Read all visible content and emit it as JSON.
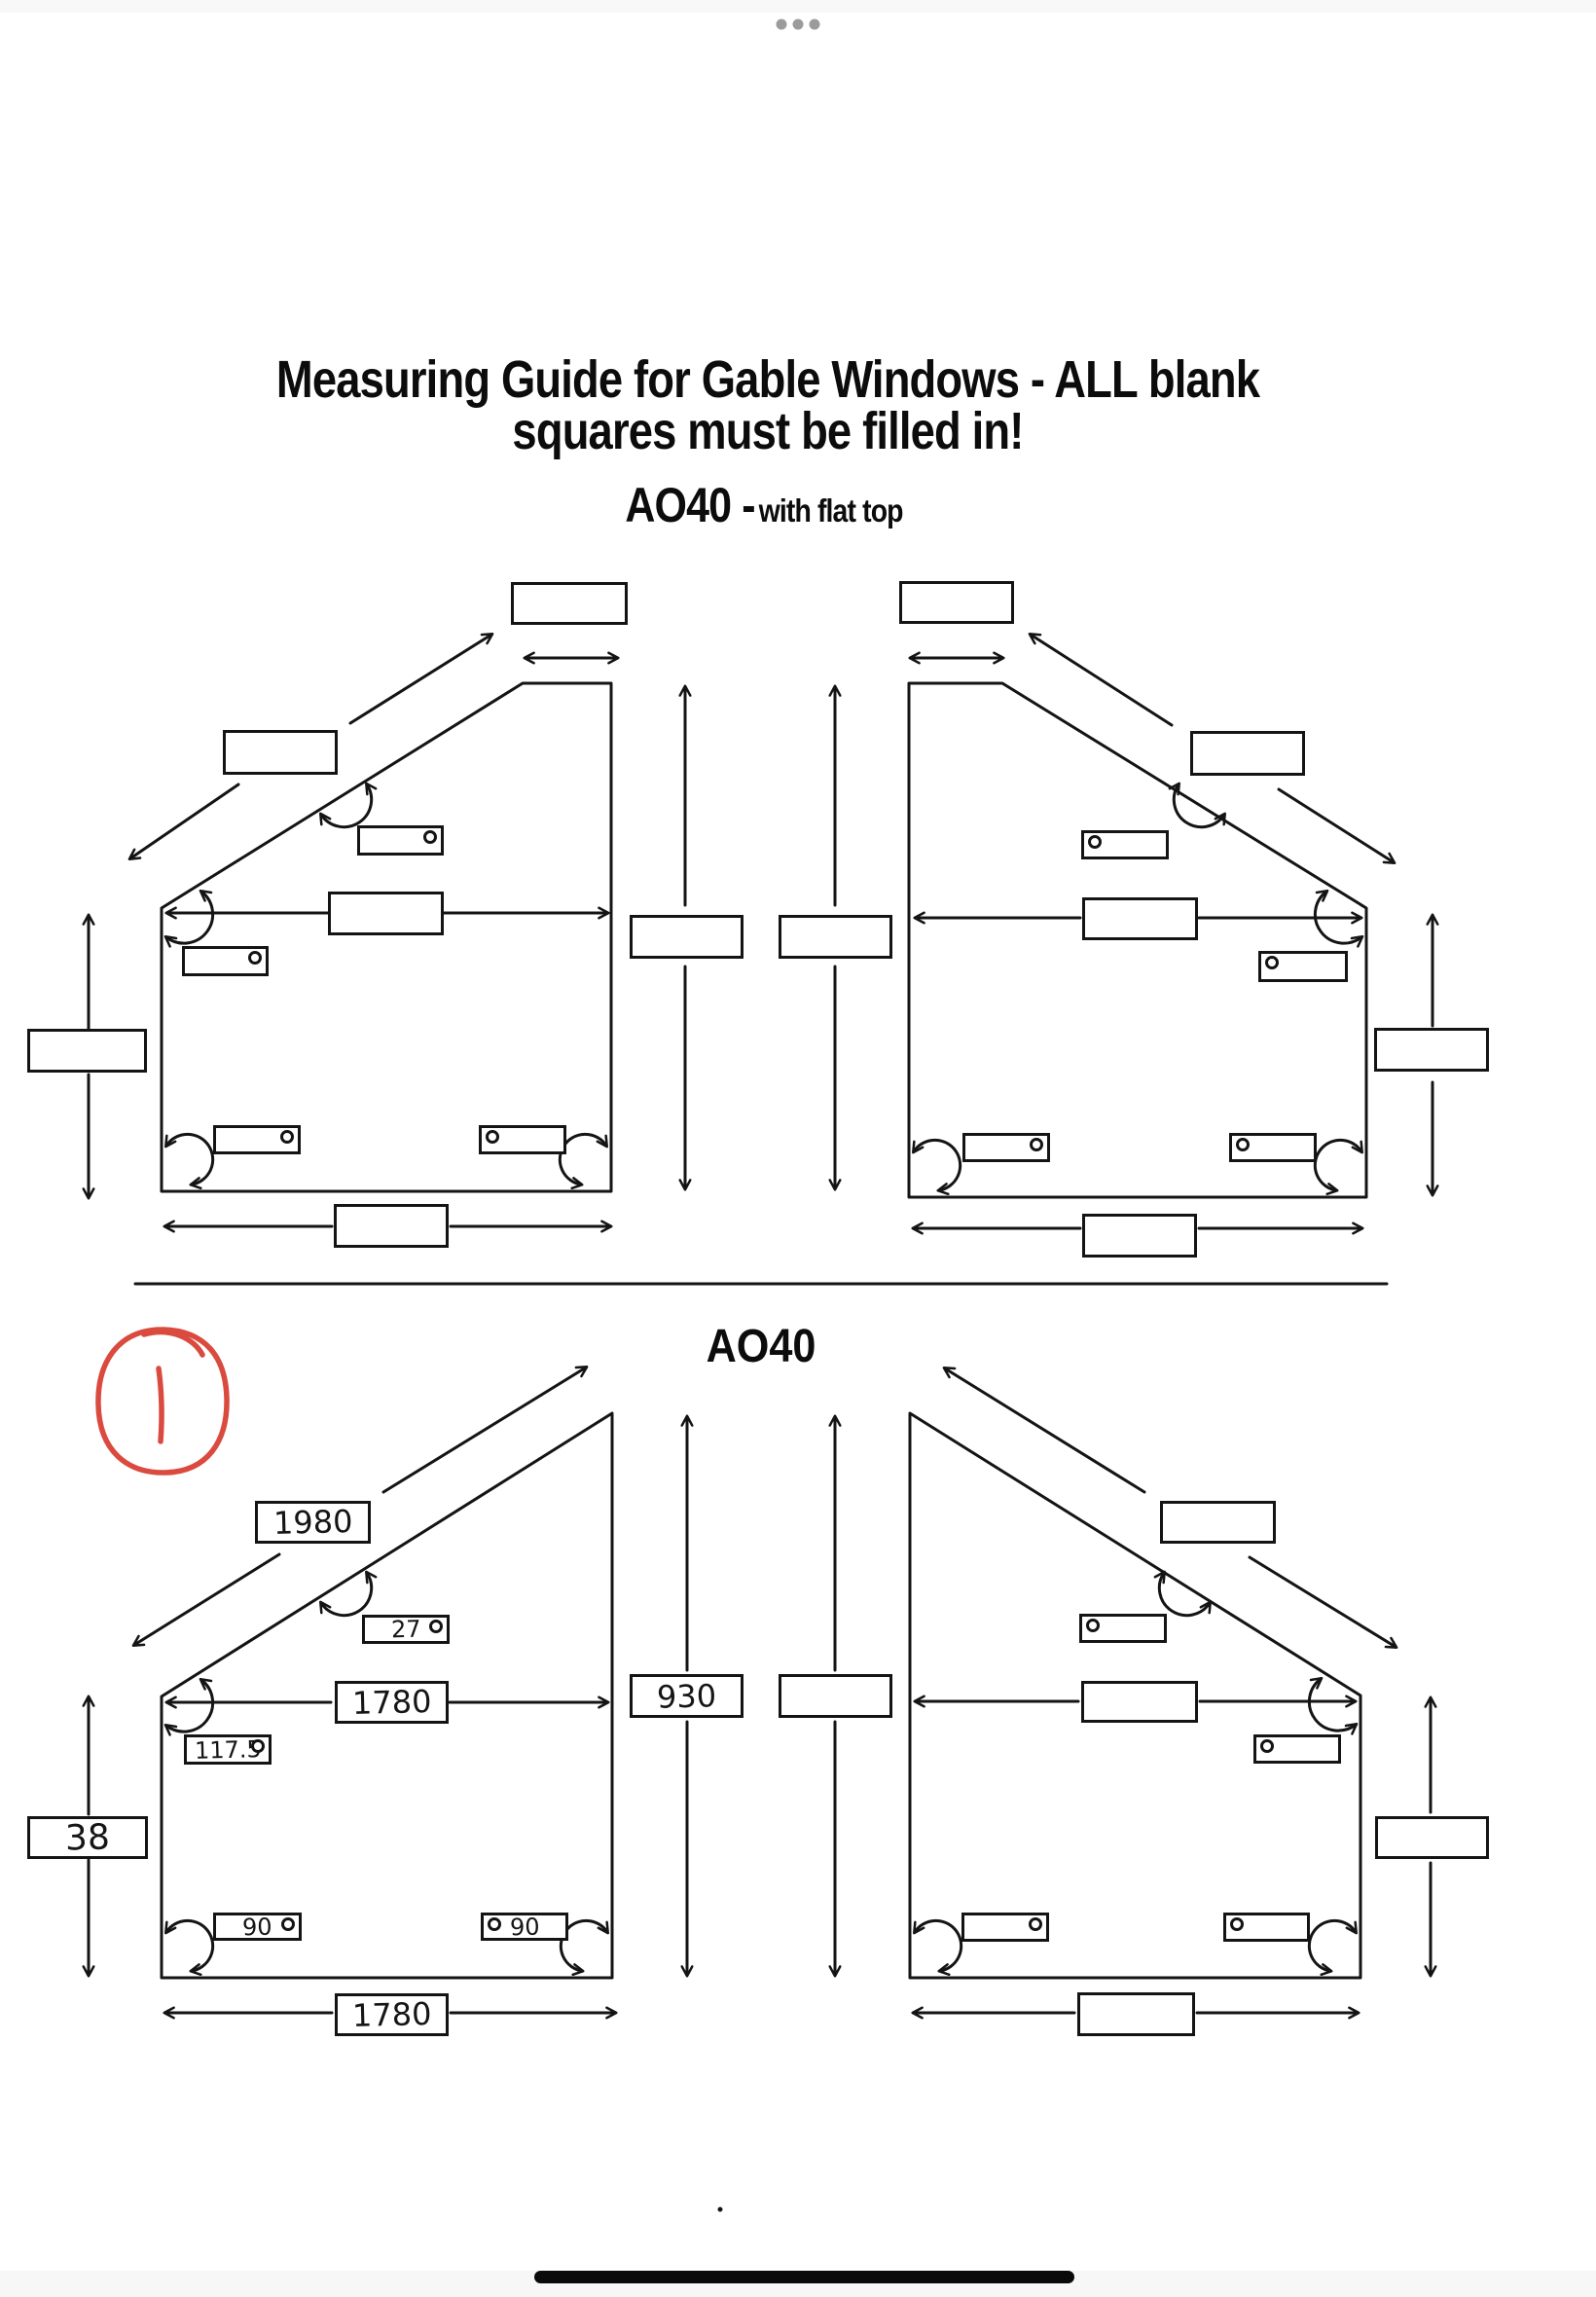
{
  "chrome": {
    "window_handle_icon": "three-dots-handle",
    "home_indicator_icon": "home-indicator-bar",
    "handle_dot_color": "#9b9b9b",
    "home_bar_color": "#0a0a0a"
  },
  "header": {
    "title_line1": "Measuring Guide for Gable Windows - ALL blank",
    "title_line2": "squares must be filled in!"
  },
  "annotation": {
    "value": "1",
    "color": "#da4a3e",
    "shape": "hand-drawn-circle"
  },
  "footer": {
    "period": "."
  },
  "colors": {
    "ink": "#141414",
    "background": "#ffffff",
    "divider": "#141414"
  },
  "sections": [
    {
      "id": "ao40-flat-top",
      "title_main": "AO40 -",
      "title_suffix": "with flat top",
      "left": {
        "top_width": "",
        "slope_length": "",
        "slope_angle": "",
        "mid_width": "",
        "corner_angle": "",
        "side_height": "",
        "bottom_left_angle": "",
        "bottom_right_angle": "",
        "bottom_width": ""
      },
      "center": {
        "height_a": "",
        "height_b": ""
      },
      "right": {
        "top_width": "",
        "slope_length": "",
        "slope_angle": "",
        "mid_width": "",
        "corner_angle": "",
        "side_height": "",
        "bottom_left_angle": "",
        "bottom_right_angle": "",
        "bottom_width": ""
      }
    },
    {
      "id": "ao40",
      "title_main": "AO40",
      "left": {
        "slope_length": "1980",
        "slope_angle": "27",
        "mid_width": "1780",
        "corner_angle": "117.5",
        "side_height": "38",
        "bottom_left_angle": "90",
        "bottom_right_angle": "90",
        "bottom_width": "1780"
      },
      "center": {
        "height_a": "930",
        "height_b": ""
      },
      "right": {
        "slope_length": "",
        "slope_angle": "",
        "mid_width": "",
        "corner_angle": "",
        "side_height": "",
        "bottom_left_angle": "",
        "bottom_right_angle": "",
        "bottom_width": ""
      }
    }
  ]
}
